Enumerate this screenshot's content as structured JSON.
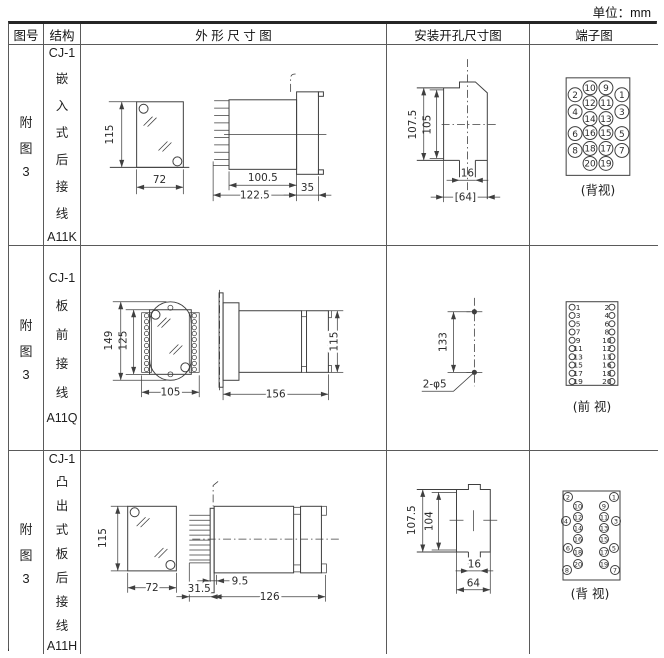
{
  "unit_label": "单位：mm",
  "header": {
    "fig": "图号",
    "structure": "结构",
    "outline": "外 形 尺 寸 图",
    "mounting": "安装开孔尺寸图",
    "terminal": "端子图"
  },
  "rows": [
    {
      "fig_lines": [
        "附",
        "图",
        "3"
      ],
      "structure_lines": [
        "CJ-1",
        "嵌",
        "入",
        "式",
        "后",
        "接",
        "线",
        "A11K"
      ],
      "outline": {
        "front_height": "115",
        "front_width": "72",
        "body_length": "100.5",
        "total_length": "122.5",
        "flange_width": "35"
      },
      "mounting": {
        "height_outer": "107.5",
        "height_inner": "105",
        "notch_width": "16",
        "width": "[64]"
      },
      "terminal": {
        "view_label": "(背视)",
        "circles": [
          {
            "n": "2",
            "x": 44,
            "y": 50
          },
          {
            "n": "10",
            "x": 59,
            "y": 43
          },
          {
            "n": "9",
            "x": 75,
            "y": 43
          },
          {
            "n": "1",
            "x": 91,
            "y": 50
          },
          {
            "n": "4",
            "x": 44,
            "y": 67
          },
          {
            "n": "12",
            "x": 59,
            "y": 58
          },
          {
            "n": "11",
            "x": 75,
            "y": 58
          },
          {
            "n": "3",
            "x": 91,
            "y": 67
          },
          {
            "n": "14",
            "x": 59,
            "y": 74
          },
          {
            "n": "13",
            "x": 75,
            "y": 74
          },
          {
            "n": "6",
            "x": 44,
            "y": 89
          },
          {
            "n": "16",
            "x": 59,
            "y": 88
          },
          {
            "n": "15",
            "x": 75,
            "y": 88
          },
          {
            "n": "5",
            "x": 91,
            "y": 89
          },
          {
            "n": "8",
            "x": 44,
            "y": 106
          },
          {
            "n": "18",
            "x": 59,
            "y": 104
          },
          {
            "n": "17",
            "x": 75,
            "y": 104
          },
          {
            "n": "7",
            "x": 91,
            "y": 106
          },
          {
            "n": "20",
            "x": 59,
            "y": 119
          },
          {
            "n": "19",
            "x": 75,
            "y": 119
          }
        ]
      }
    },
    {
      "fig_lines": [
        "附",
        "图",
        "3"
      ],
      "structure_lines": [
        "CJ-1",
        "板",
        "前",
        "接",
        "线",
        "A11Q"
      ],
      "outline": {
        "plate_height": "149",
        "body_height": "125",
        "front_width": "105",
        "total_length": "156",
        "rear_height": "115"
      },
      "mounting": {
        "hole_spacing": "133",
        "hole_note": "2-φ5"
      },
      "terminal": {
        "view_label": "(前 视)",
        "rows": [
          [
            "1",
            "2"
          ],
          [
            "3",
            "4"
          ],
          [
            "5",
            "6"
          ],
          [
            "7",
            "8"
          ],
          [
            "9",
            "10"
          ],
          [
            "11",
            "12"
          ],
          [
            "13",
            "13"
          ],
          [
            "15",
            "16"
          ],
          [
            "17",
            "18"
          ],
          [
            "19",
            "20"
          ]
        ]
      }
    },
    {
      "fig_lines": [
        "附",
        "图",
        "3"
      ],
      "structure_lines": [
        "CJ-1",
        "凸",
        "出",
        "式",
        "板",
        "后",
        "接",
        "线",
        "A11H"
      ],
      "outline": {
        "front_height": "115",
        "front_width": "72",
        "plate_offset": "9.5",
        "pin_length": "31.5",
        "total_length": "126"
      },
      "mounting": {
        "height_outer": "107.5",
        "height_inner": "104",
        "notch_width": "16",
        "width": "64"
      },
      "terminal": {
        "view_label": "(背 视)",
        "circles": [
          {
            "n": "2",
            "x": 37,
            "y": 46
          },
          {
            "n": "1",
            "x": 83,
            "y": 46
          },
          {
            "n": "10",
            "x": 47,
            "y": 55
          },
          {
            "n": "9",
            "x": 73,
            "y": 55
          },
          {
            "n": "4",
            "x": 35,
            "y": 70
          },
          {
            "n": "12",
            "x": 47,
            "y": 66
          },
          {
            "n": "11",
            "x": 73,
            "y": 66
          },
          {
            "n": "3",
            "x": 85,
            "y": 70
          },
          {
            "n": "14",
            "x": 47,
            "y": 77
          },
          {
            "n": "13",
            "x": 73,
            "y": 77
          },
          {
            "n": "6",
            "x": 37,
            "y": 97
          },
          {
            "n": "16",
            "x": 47,
            "y": 88
          },
          {
            "n": "15",
            "x": 73,
            "y": 88
          },
          {
            "n": "5",
            "x": 83,
            "y": 97
          },
          {
            "n": "18",
            "x": 47,
            "y": 101
          },
          {
            "n": "17",
            "x": 73,
            "y": 101
          },
          {
            "n": "8",
            "x": 36,
            "y": 119
          },
          {
            "n": "20",
            "x": 47,
            "y": 113
          },
          {
            "n": "19",
            "x": 73,
            "y": 113
          },
          {
            "n": "7",
            "x": 84,
            "y": 119
          }
        ]
      }
    }
  ]
}
